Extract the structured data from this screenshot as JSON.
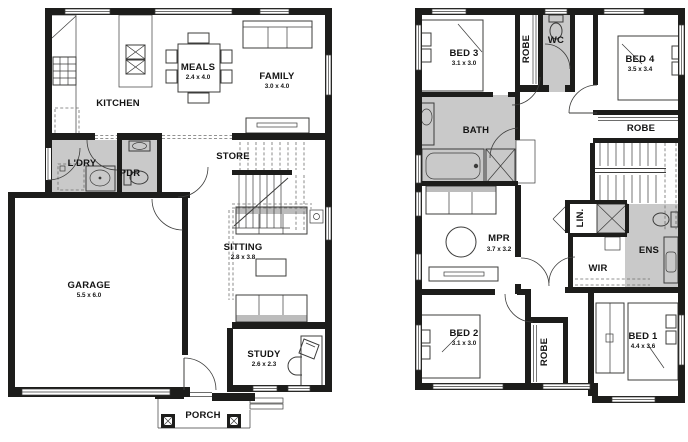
{
  "ground": {
    "rooms": {
      "kitchen": {
        "label": "KITCHEN"
      },
      "meals": {
        "label": "MEALS",
        "dim": "2.4 x 4.0"
      },
      "family": {
        "label": "FAMILY",
        "dim": "3.0 x 4.0"
      },
      "ldry": {
        "label": "L'DRY"
      },
      "pdr": {
        "label": "PDR"
      },
      "store": {
        "label": "STORE"
      },
      "sitting": {
        "label": "SITTING",
        "dim": "2.8 x 3.8"
      },
      "garage": {
        "label": "GARAGE",
        "dim": "5.5 x 6.0"
      },
      "study": {
        "label": "STUDY",
        "dim": "2.6 x 2.3"
      },
      "porch": {
        "label": "PORCH"
      }
    }
  },
  "first": {
    "rooms": {
      "bed3": {
        "label": "BED 3",
        "dim": "3.1 x 3.0"
      },
      "robe3": {
        "label": "ROBE"
      },
      "wc": {
        "label": "WC"
      },
      "bed4": {
        "label": "BED 4",
        "dim": "3.5 x 3.4"
      },
      "bath": {
        "label": "BATH"
      },
      "robe4": {
        "label": "ROBE"
      },
      "lin": {
        "label": "LIN."
      },
      "mpr": {
        "label": "MPR",
        "dim": "3.7 x 3.2"
      },
      "wir": {
        "label": "WIR"
      },
      "ens": {
        "label": "ENS"
      },
      "bed2": {
        "label": "BED 2",
        "dim": "3.1 x 3.0"
      },
      "robe2": {
        "label": "ROBE"
      },
      "bed1": {
        "label": "BED 1",
        "dim": "4.4 x 3.6"
      }
    }
  },
  "colors": {
    "wall": "#1d1d1b",
    "wet_area": "#c9c9c9",
    "line": "#3c3c3b"
  }
}
